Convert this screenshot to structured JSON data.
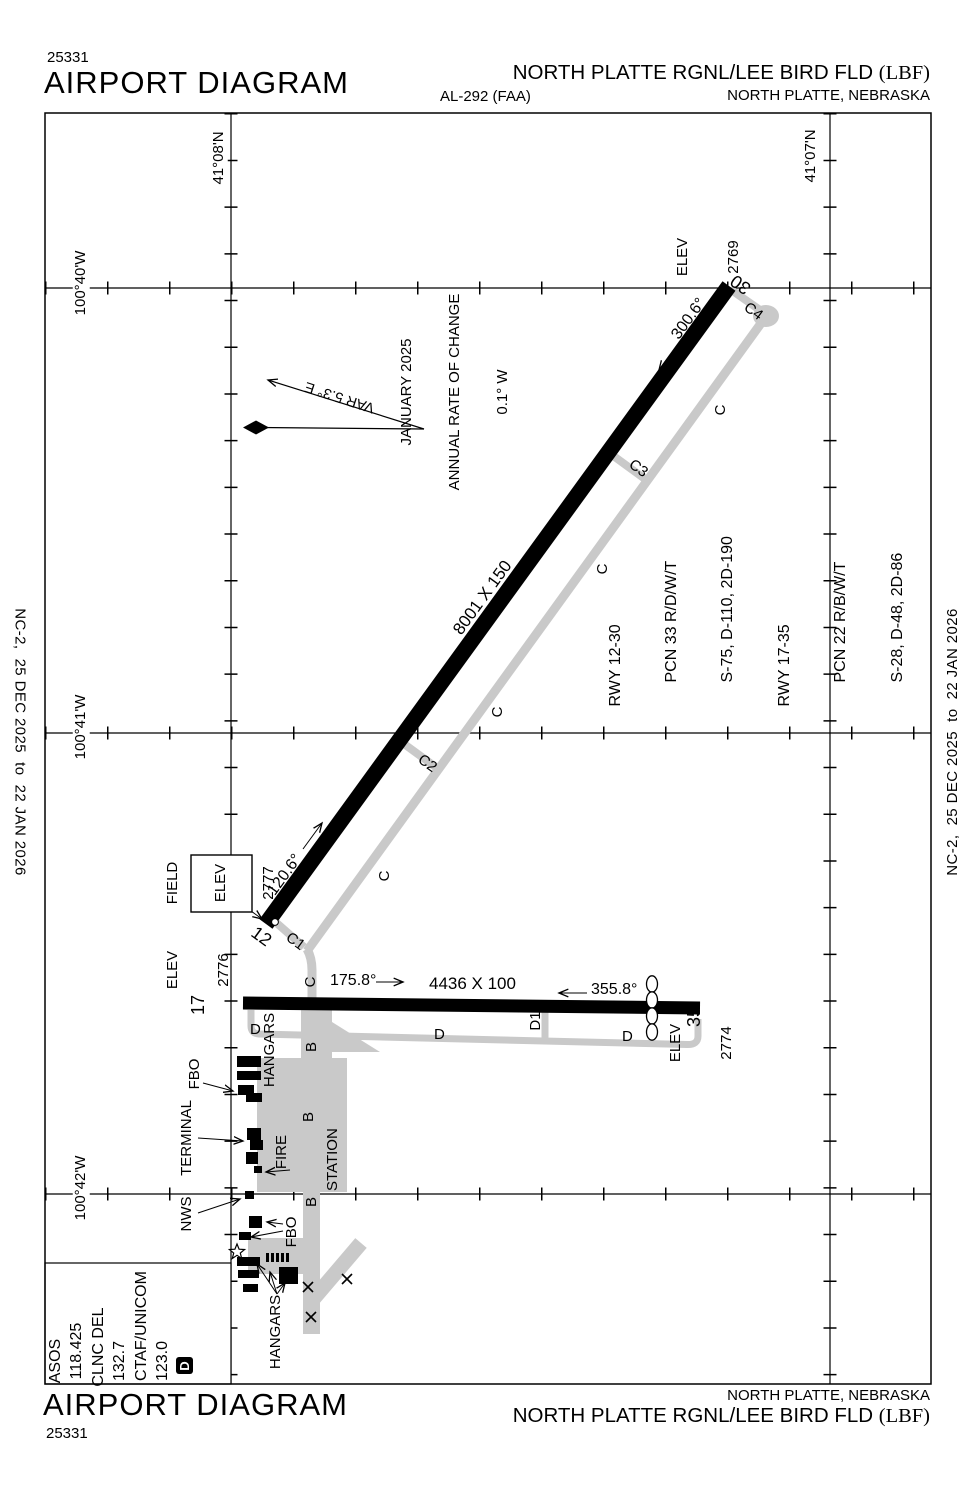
{
  "header": {
    "chart_number": "25331",
    "title": "AIRPORT DIAGRAM",
    "chart_code": "AL-292 (FAA)",
    "airport_name": "NORTH PLATTE RGNL/LEE BIRD FLD ",
    "airport_id": "(LBF)",
    "location": "NORTH PLATTE, NEBRASKA"
  },
  "footer": {
    "chart_number": "25331",
    "title": "AIRPORT DIAGRAM",
    "airport_name": "NORTH PLATTE RGNL/LEE BIRD FLD ",
    "airport_id": "(LBF)",
    "location": "NORTH PLATTE, NEBRASKA"
  },
  "binding": {
    "edition": "NC-2,  25 DEC 2025  to  22 JAN 2026"
  },
  "graticule": {
    "lat1": "41°08'N",
    "lat2": "41°07'N",
    "lon1": "100°40'W",
    "lon2": "100°41'W",
    "lon3": "100°42'W"
  },
  "compass": {
    "variation": "VAR 5.3° E",
    "date": "JANUARY 2025",
    "rate_label": "ANNUAL RATE OF CHANGE",
    "rate_value": "0.1° W"
  },
  "field_elevation": {
    "line1": "FIELD",
    "line2": "ELEV",
    "value": "2777"
  },
  "runway_12_30": {
    "end12": "12",
    "end30": "30",
    "dimensions": "8001 X 150",
    "heading12": "120.6°",
    "heading30": "300.6°",
    "elev30_label": "ELEV",
    "elev30_value": "2769"
  },
  "runway_17_35": {
    "end17": "17",
    "end35": "35",
    "dimensions": "4436 X 100",
    "heading17": "175.8°",
    "heading35": "355.8°",
    "elev17_label": "ELEV",
    "elev17_value": "2776",
    "elev35_label": "ELEV",
    "elev35_value": "2774"
  },
  "pcn": {
    "rwy1230": "RWY 12-30",
    "pcn1230": "PCN 33 R/D/W/T",
    "strength1230": "S-75, D-110, 2D-190",
    "rwy1735": "RWY 17-35",
    "pcn1735": "PCN 22 R/B/W/T",
    "strength1735": "S-28, D-48, 2D-86"
  },
  "taxiways": {
    "c": "C",
    "c1": "C1",
    "c2": "C2",
    "c3": "C3",
    "c4": "C4",
    "d": "D",
    "d1": "D1",
    "b": "B"
  },
  "facilities": {
    "hangars": "HANGARS",
    "fbo": "FBO",
    "terminal": "TERMINAL",
    "fire_line1": "FIRE",
    "fire_line2": "STATION",
    "nws": "NWS"
  },
  "frequencies": {
    "asos_label": "ASOS",
    "asos_value": "118.425",
    "clnc_label": "CLNC DEL",
    "clnc_value": "132.7",
    "ctaf_label": "CTAF/UNICOM",
    "ctaf_value": "123.0",
    "class_d": "D"
  },
  "colors": {
    "taxiway_gray": "#c9c9c9",
    "runway_black": "#000000",
    "paper_white": "#ffffff"
  }
}
